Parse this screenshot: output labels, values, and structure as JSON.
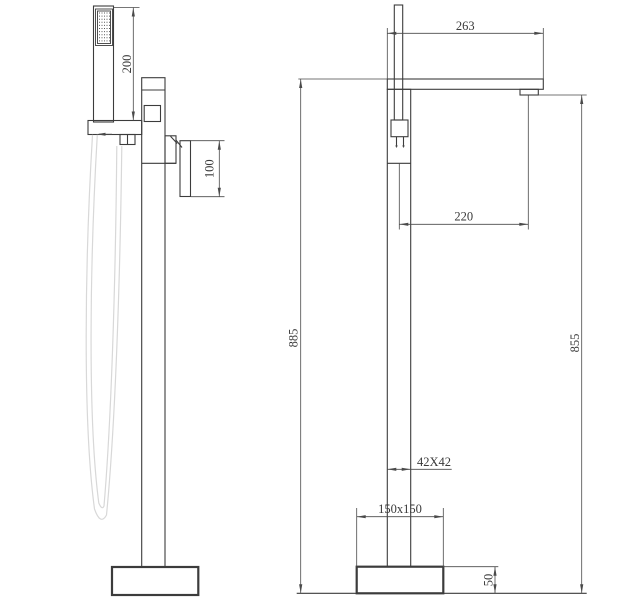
{
  "colors": {
    "line": "#3c3c3c",
    "dimension": "#4a4a4a",
    "hose": "#d8d8d8",
    "background": "#ffffff"
  },
  "dimensions": {
    "side_view": {
      "handshower_length": "200",
      "handle_height": "100"
    },
    "front_view": {
      "spout_reach": "263",
      "spout_outlet_offset": "220",
      "total_height": "885",
      "outlet_height": "855",
      "column_section": "42X42",
      "base_plate": "150x150",
      "base_height": "50"
    }
  }
}
